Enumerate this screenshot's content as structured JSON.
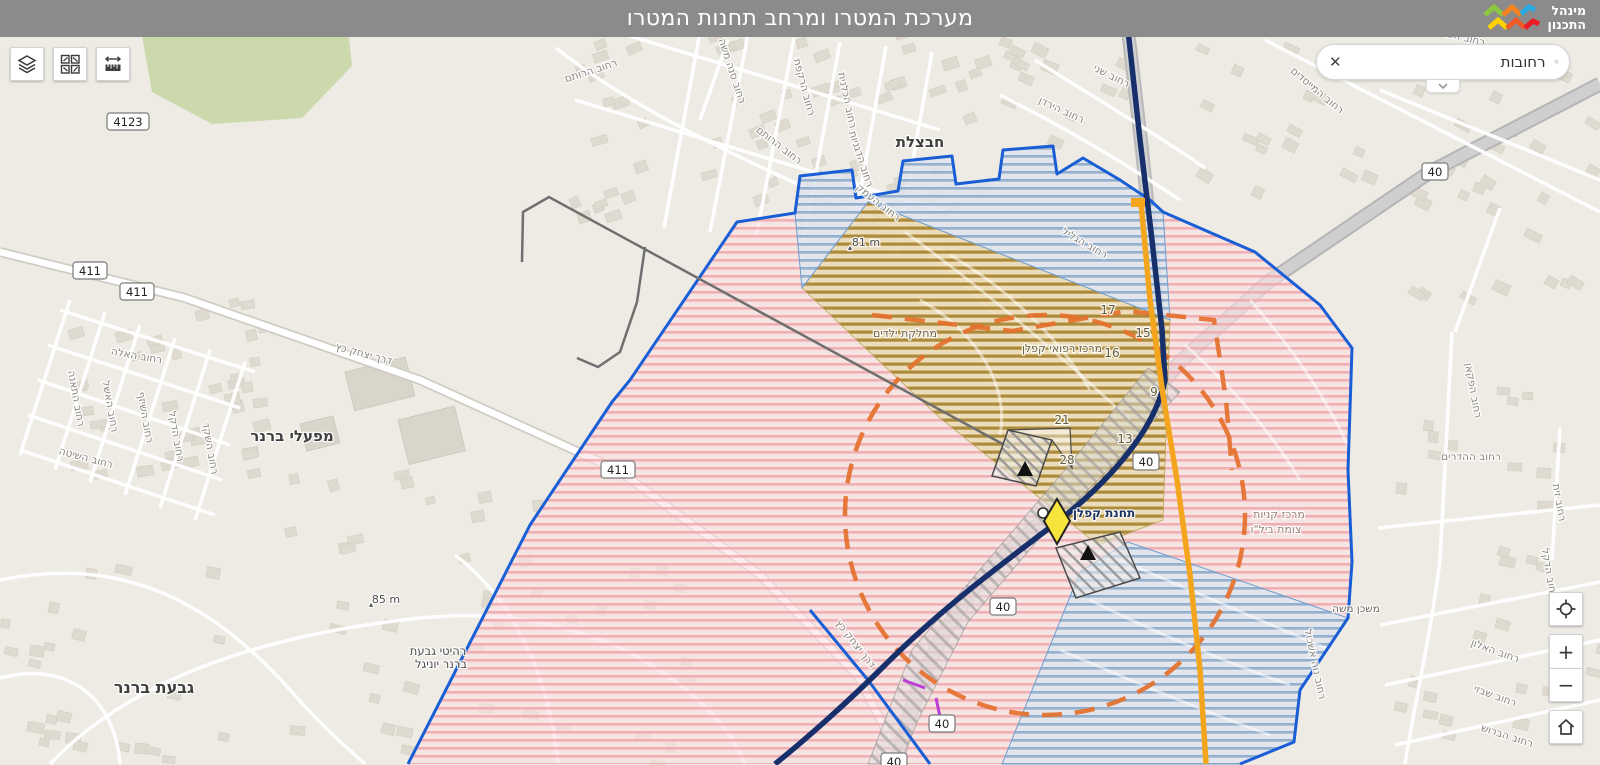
{
  "header": {
    "title": "מערכת המטרו ומרחב תחנות המטרו",
    "logo_line1": "מינהל",
    "logo_line2": "התכנון"
  },
  "toolbar": {
    "layers_icon": "layers-icon",
    "basemap_gallery_icon": "basemap-gallery-icon",
    "measure_icon": "measure-ruler-icon"
  },
  "search": {
    "value": "רחובות",
    "clear_icon": "✕",
    "search_icon": "magnifier",
    "collapse_icon": "chevron-down"
  },
  "zoom_controls": {
    "zoom_in": "+",
    "zoom_out": "−",
    "locate_icon": "crosshair",
    "home_icon": "house"
  },
  "map": {
    "station": {
      "name": "תחנת קפלן",
      "x": 1104,
      "y": 517
    },
    "colors": {
      "boundary_blue": "#1a5ed6",
      "metro_navy": "#17306b",
      "metro_orange": "#f3a51d",
      "dashed_orange": "#e4702d",
      "zone_pink_stripe": "#efa3a9",
      "zone_blue_stripe": "#86abcd",
      "zone_olive_stripe": "#9c7c20",
      "magenta": "#b93fd6"
    },
    "route_shields": [
      {
        "t": "4123",
        "x": 128,
        "y": 122
      },
      {
        "t": "411",
        "x": 90,
        "y": 271
      },
      {
        "t": "411",
        "x": 137,
        "y": 292
      },
      {
        "t": "411",
        "x": 618,
        "y": 470
      },
      {
        "t": "40",
        "x": 1435,
        "y": 172
      },
      {
        "t": "40",
        "x": 1146,
        "y": 462
      },
      {
        "t": "40",
        "x": 1003,
        "y": 607
      },
      {
        "t": "40",
        "x": 942,
        "y": 724
      },
      {
        "t": "40",
        "x": 894,
        "y": 762
      }
    ],
    "labels": [
      {
        "t": "רחוב הרותם",
        "x": 592,
        "y": 74,
        "r": -18
      },
      {
        "t": "רחוב סנה משה",
        "x": 729,
        "y": 72,
        "r": 72
      },
      {
        "t": "רחוב הרקפת",
        "x": 801,
        "y": 88,
        "r": 75
      },
      {
        "t": "רחוב הכלנית",
        "x": 844,
        "y": 101,
        "r": 78
      },
      {
        "t": "רחוב הדגניות",
        "x": 858,
        "y": 160,
        "r": 72
      },
      {
        "t": "רחוב העמק",
        "x": 876,
        "y": 205,
        "r": 38
      },
      {
        "t": "רחוב הרותם",
        "x": 777,
        "y": 148,
        "r": 38
      },
      {
        "t": "רחוב שני",
        "x": 1110,
        "y": 79,
        "r": 27
      },
      {
        "t": "רחוב הירדן",
        "x": 1060,
        "y": 113,
        "r": 25
      },
      {
        "t": "רחוב המייסדים",
        "x": 1315,
        "y": 93,
        "r": 40
      },
      {
        "t": "רחוב הפרדסים",
        "x": 1452,
        "y": 38,
        "r": 14
      },
      {
        "t": "רחוב הגליל",
        "x": 1083,
        "y": 246,
        "r": 30
      },
      {
        "t": "דרך יצחק כץ",
        "x": 363,
        "y": 357,
        "r": 15
      },
      {
        "t": "דרך יצחק כץ",
        "x": 853,
        "y": 646,
        "r": 52
      },
      {
        "t": "רחוב האלה",
        "x": 136,
        "y": 359,
        "r": 10
      },
      {
        "t": "רחוב התאנה",
        "x": 73,
        "y": 399,
        "r": 80
      },
      {
        "t": "רחוב האשל",
        "x": 107,
        "y": 407,
        "r": 80
      },
      {
        "t": "רחוב השיזף",
        "x": 142,
        "y": 418,
        "r": 80
      },
      {
        "t": "רחוב הדקל",
        "x": 173,
        "y": 437,
        "r": 80
      },
      {
        "t": "רחוב השקד",
        "x": 207,
        "y": 449,
        "r": 80
      },
      {
        "t": "רחוב השיטה",
        "x": 85,
        "y": 461,
        "r": 15
      },
      {
        "t": "רחוב ההדרים",
        "x": 1471,
        "y": 460,
        "r": 0
      },
      {
        "t": "רחוב הפקאן",
        "x": 1470,
        "y": 391,
        "r": 80
      },
      {
        "t": "רחוב האלון",
        "x": 1494,
        "y": 654,
        "r": 20
      },
      {
        "t": "רחוב שבזי",
        "x": 1494,
        "y": 699,
        "r": 20
      },
      {
        "t": "רחוב הברוש",
        "x": 1506,
        "y": 739,
        "r": 18
      },
      {
        "t": "רחוב זית",
        "x": 1556,
        "y": 503,
        "r": 80
      },
      {
        "t": "רחוב הדקל",
        "x": 1546,
        "y": 574,
        "r": 80
      },
      {
        "t": "רחוב נוה אשכול",
        "x": 1312,
        "y": 665,
        "r": 78
      },
      {
        "t": "משכן משה",
        "x": 1356,
        "y": 612,
        "r": 0,
        "c": "#6b675f"
      },
      {
        "t": "מרכז רפואי קפלן",
        "x": 1062,
        "y": 352,
        "s": 11,
        "c": "#6e6448"
      },
      {
        "t": "מחלקת ילדים",
        "x": 905,
        "y": 337,
        "s": 11,
        "c": "#6e6448"
      },
      {
        "t": "מרכז קניות",
        "x": 1279,
        "y": 518,
        "s": 11,
        "c": "#9b8579"
      },
      {
        "t": "צומת ביל\"ו",
        "x": 1276,
        "y": 533,
        "s": 11,
        "c": "#9b8579"
      },
      {
        "t": "רהיטי גבעת",
        "x": 438,
        "y": 655,
        "s": 11.5,
        "c": "#4a4a4a"
      },
      {
        "t": "ברנר יוניגל",
        "x": 441,
        "y": 668,
        "s": 11.5,
        "c": "#4a4a4a"
      },
      {
        "t": "חבצלת",
        "x": 920,
        "y": 147,
        "s": 15,
        "c": "#3e3e3e",
        "b": 1
      },
      {
        "t": "מפעלי ברנר",
        "x": 292,
        "y": 441,
        "s": 15,
        "c": "#3e3e3e",
        "b": 1
      },
      {
        "t": "גבעת ברנר",
        "x": 154,
        "y": 693,
        "s": 16,
        "c": "#3e3e3e",
        "b": 1
      },
      {
        "t": "81 m",
        "x": 866,
        "y": 246,
        "s": 11,
        "c": "#4f4f4f"
      },
      {
        "t": "▴",
        "x": 850,
        "y": 250,
        "s": 8,
        "c": "#4f4f4f"
      },
      {
        "t": "85 m",
        "x": 386,
        "y": 603,
        "s": 11,
        "c": "#4f4f4f"
      },
      {
        "t": "▴",
        "x": 371,
        "y": 607,
        "s": 8,
        "c": "#4f4f4f"
      }
    ],
    "parcel_numbers": [
      {
        "t": "17",
        "x": 1108,
        "y": 314
      },
      {
        "t": "15",
        "x": 1143,
        "y": 337
      },
      {
        "t": "16",
        "x": 1112,
        "y": 357
      },
      {
        "t": "9",
        "x": 1154,
        "y": 396
      },
      {
        "t": "21",
        "x": 1062,
        "y": 424
      },
      {
        "t": "13",
        "x": 1125,
        "y": 443
      },
      {
        "t": "28",
        "x": 1067,
        "y": 464
      }
    ]
  }
}
